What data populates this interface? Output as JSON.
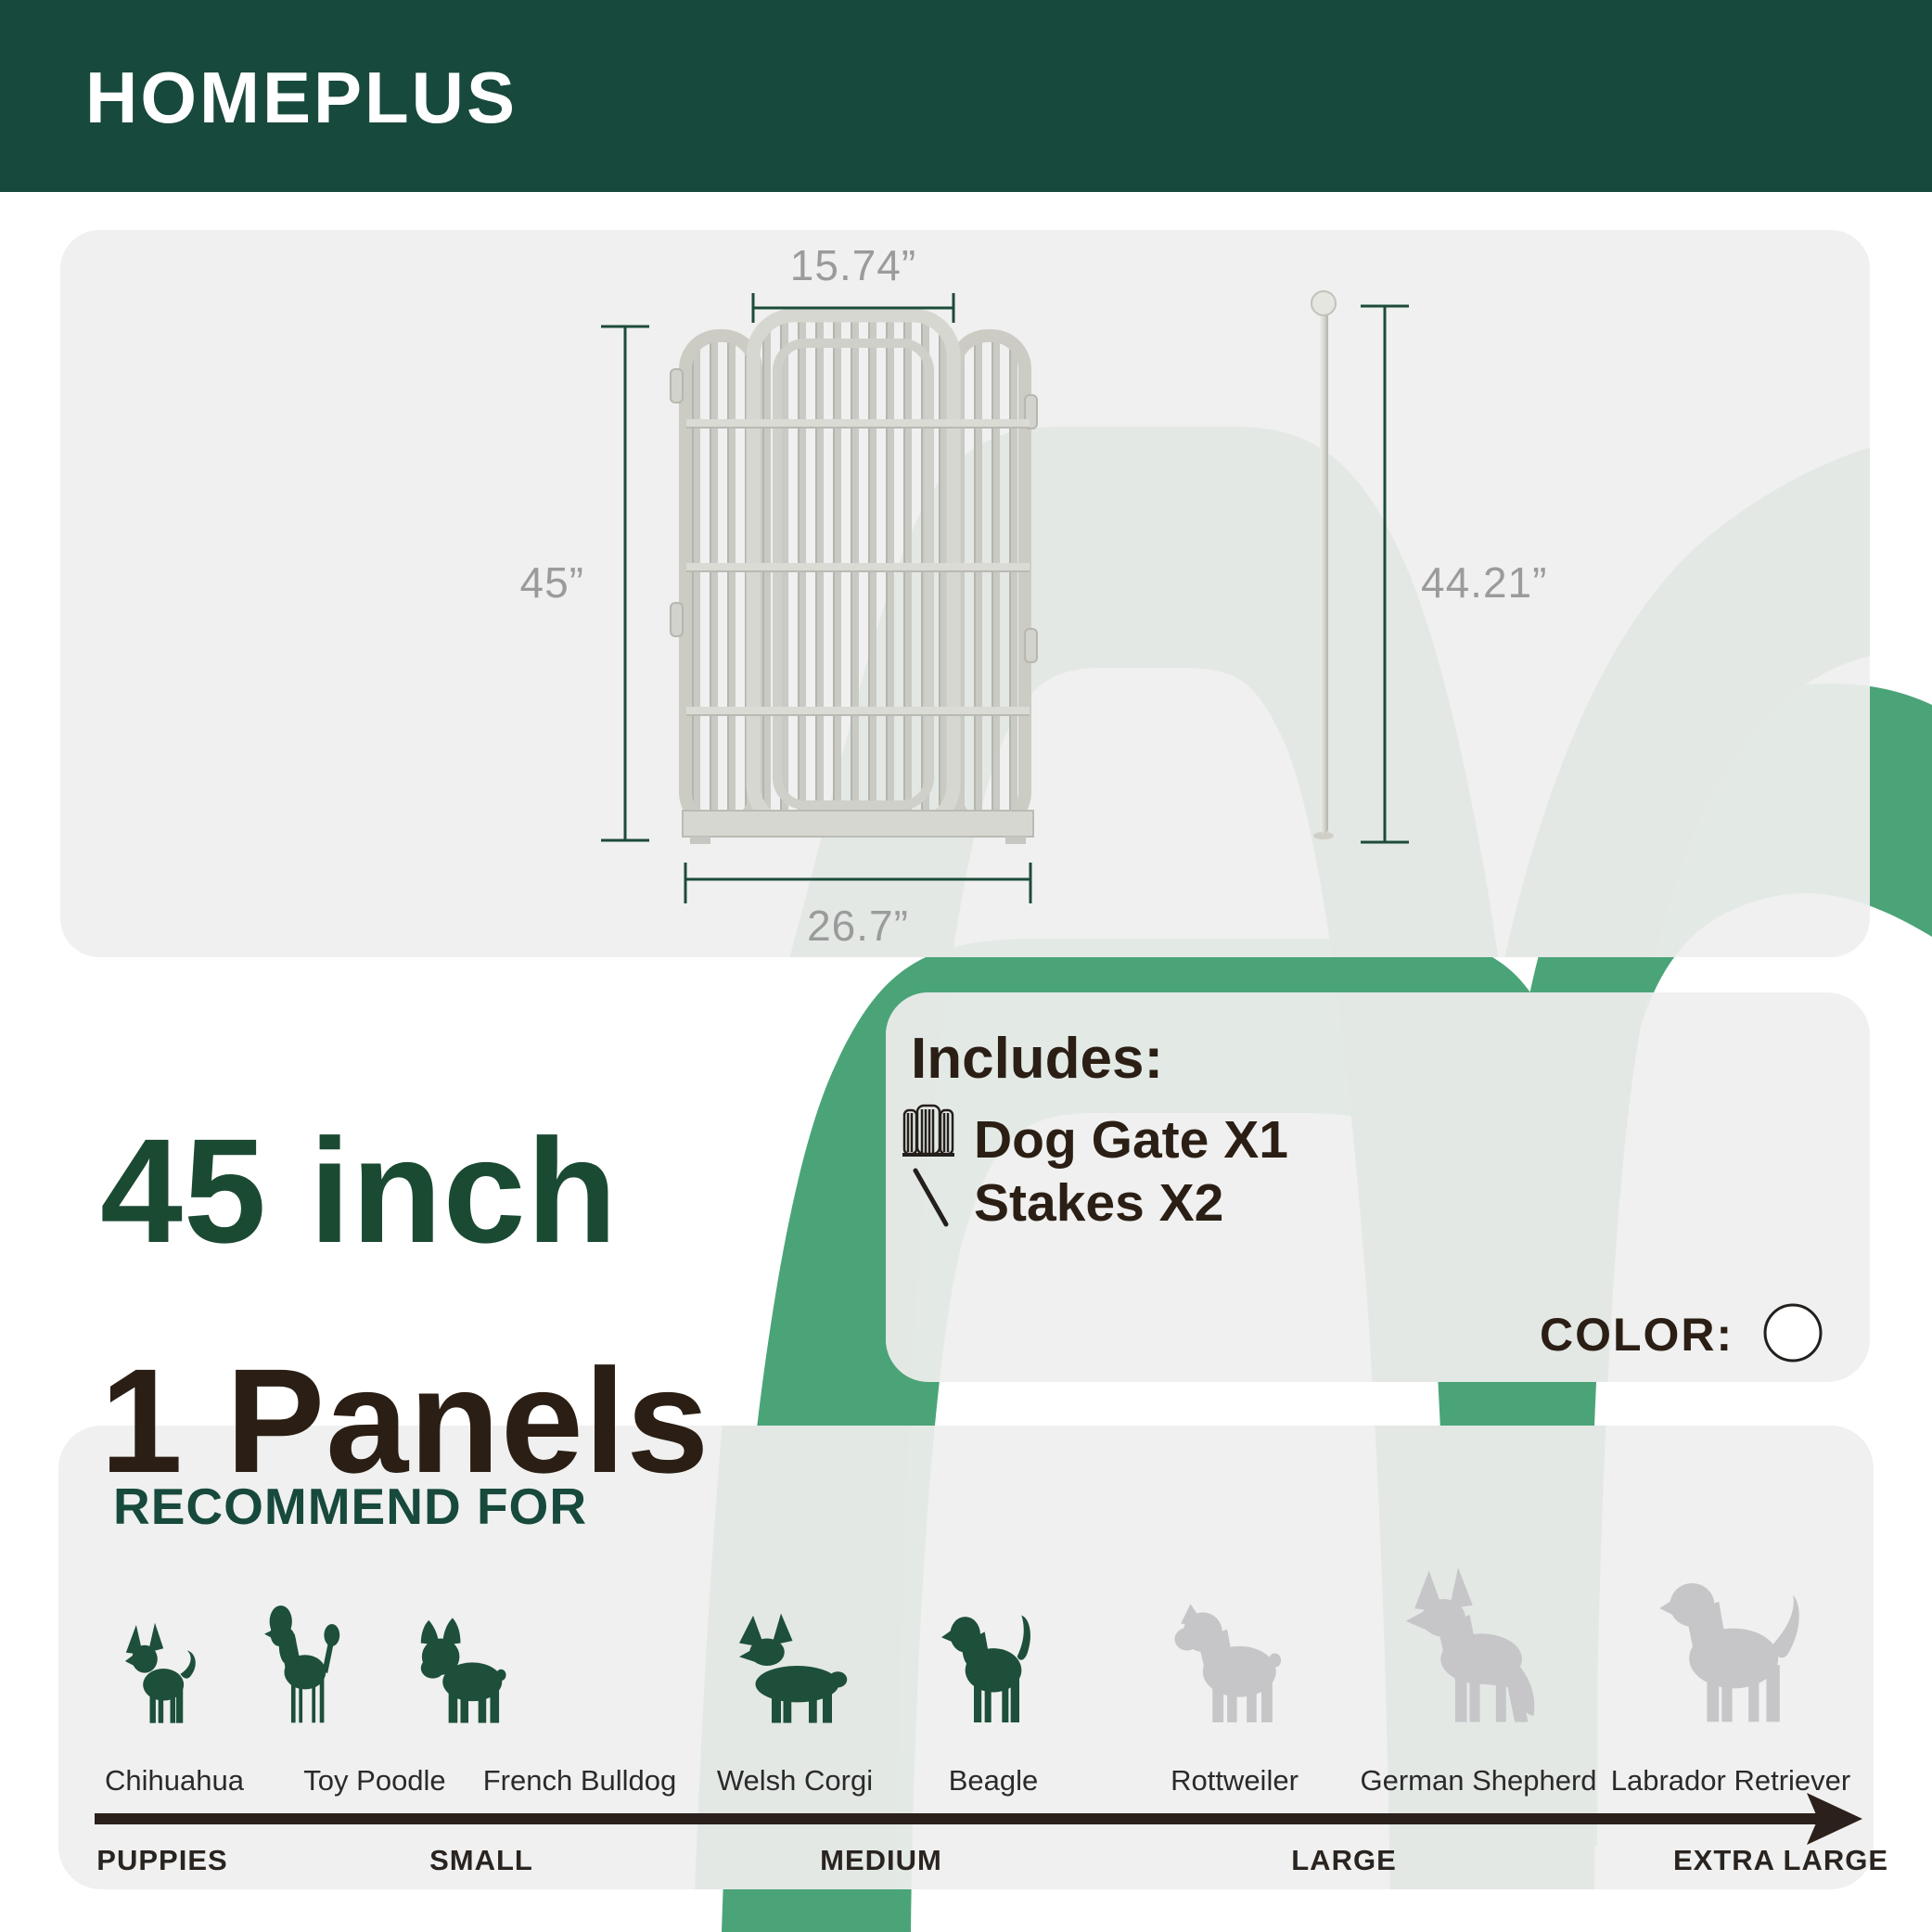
{
  "brand": {
    "name": "HOMEPLUS"
  },
  "colors": {
    "header_green": "#17493c",
    "accent_green": "#4ba478",
    "swoosh_light": "#e3e8e5",
    "panel_gray": "#edeeed",
    "dim_green": "#1d4b3a",
    "dim_text": "#9b9b9b",
    "headline_green": "#1b4a33",
    "text_dark": "#2b1f15",
    "dog_green": "#1d4f3a",
    "dog_gray": "#c6c6c8",
    "arrow_dark": "#2b201b"
  },
  "diagram": {
    "top_width": "15.74”",
    "height": "45”",
    "bottom_width": "26.7”",
    "stake_height": "44.21”"
  },
  "headline": {
    "size": "45 inch",
    "panels": "1 Panels"
  },
  "includes": {
    "title": "Includes:",
    "items": [
      {
        "icon": "dog-gate-icon",
        "label": "Dog Gate X1"
      },
      {
        "icon": "stake-icon",
        "label": "Stakes X2"
      }
    ],
    "color_label": "COLOR:",
    "swatch": "#ffffff"
  },
  "recommend": {
    "title": "RECOMMEND FOR",
    "breeds": [
      {
        "name": "Chihuahua",
        "highlighted": true
      },
      {
        "name": "Toy Poodle",
        "highlighted": true
      },
      {
        "name": "French Bulldog",
        "highlighted": true
      },
      {
        "name": "Welsh Corgi",
        "highlighted": true
      },
      {
        "name": "Beagle",
        "highlighted": true
      },
      {
        "name": "Rottweiler",
        "highlighted": false
      },
      {
        "name": "German Shepherd",
        "highlighted": false
      },
      {
        "name": "Labrador Retriever",
        "highlighted": false
      }
    ],
    "sizes": [
      "PUPPIES",
      "SMALL",
      "MEDIUM",
      "LARGE",
      "EXTRA LARGE"
    ]
  }
}
